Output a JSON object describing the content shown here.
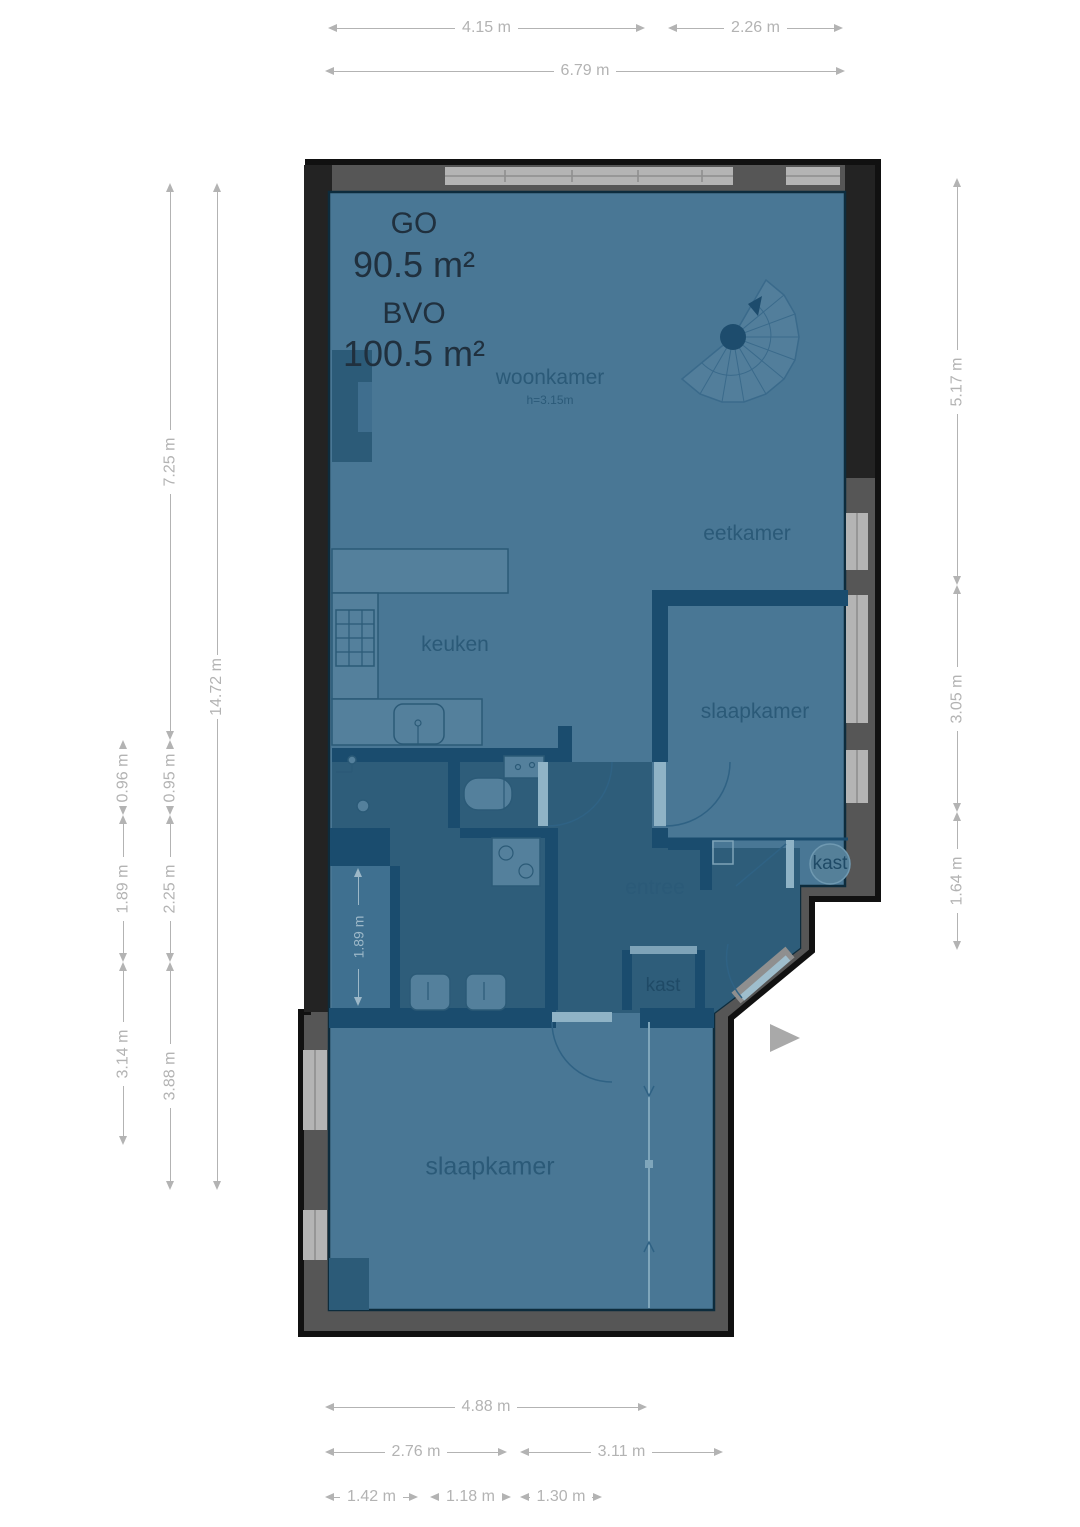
{
  "plan": {
    "type": "floorplan",
    "area": {
      "go_label": "GO",
      "go_value": "90.5 m²",
      "bvo_label": "BVO",
      "bvo_value": "100.5 m²"
    },
    "rooms": {
      "woonkamer": {
        "label": "woonkamer",
        "height_note": "h=3.15m"
      },
      "eetkamer": {
        "label": "eetkamer"
      },
      "keuken": {
        "label": "keuken"
      },
      "slaapkamer_right": {
        "label": "slaapkamer"
      },
      "entree": {
        "label": "entree"
      },
      "kast_upper": {
        "label": "kast"
      },
      "kast_lower": {
        "label": "kast"
      },
      "slaapkamer_bottom": {
        "label": "slaapkamer"
      }
    },
    "dims": {
      "t1": "4.15 m",
      "t2": "2.26 m",
      "t3": "6.79 m",
      "l_outer_1": "0.96 m",
      "l_outer_2": "1.89 m",
      "l_outer_3": "3.14 m",
      "l_mid_1": "7.25 m",
      "l_mid_2": "0.95 m",
      "l_mid_3": "2.25 m",
      "l_mid_4": "3.88 m",
      "l_total": "14.72 m",
      "r1": "5.17 m",
      "r2": "3.05 m",
      "r3": "1.64 m",
      "b_total": "4.88 m",
      "b2a": "2.76 m",
      "b2b": "3.11 m",
      "b3a": "1.42 m",
      "b3b": "1.18 m",
      "b3c": "1.30 m",
      "interior_1": "1.89 m"
    }
  },
  "colors": {
    "room_fill": "#497795",
    "hall_fill": "#2e5d7a",
    "corridor_fill": "#3f7090",
    "wall_dark": "#1a4c6e",
    "outline": "#111111",
    "ext_wall": "#565656",
    "ext_wall_dark": "#232323",
    "window_light": "#b4b4b4",
    "window_line": "#8d8d8d",
    "dim_line": "#b3b3b3",
    "label_text": "#2b5a78",
    "area_text": "#20303e",
    "door_leaf": "#8fb3c6",
    "fixture_fill": "#54809c",
    "fixture_line": "#2b5a77",
    "stairs_fill": "#527e9b",
    "stairs_line": "#3a6a8b",
    "marker_gray": "#a9a9a9"
  }
}
